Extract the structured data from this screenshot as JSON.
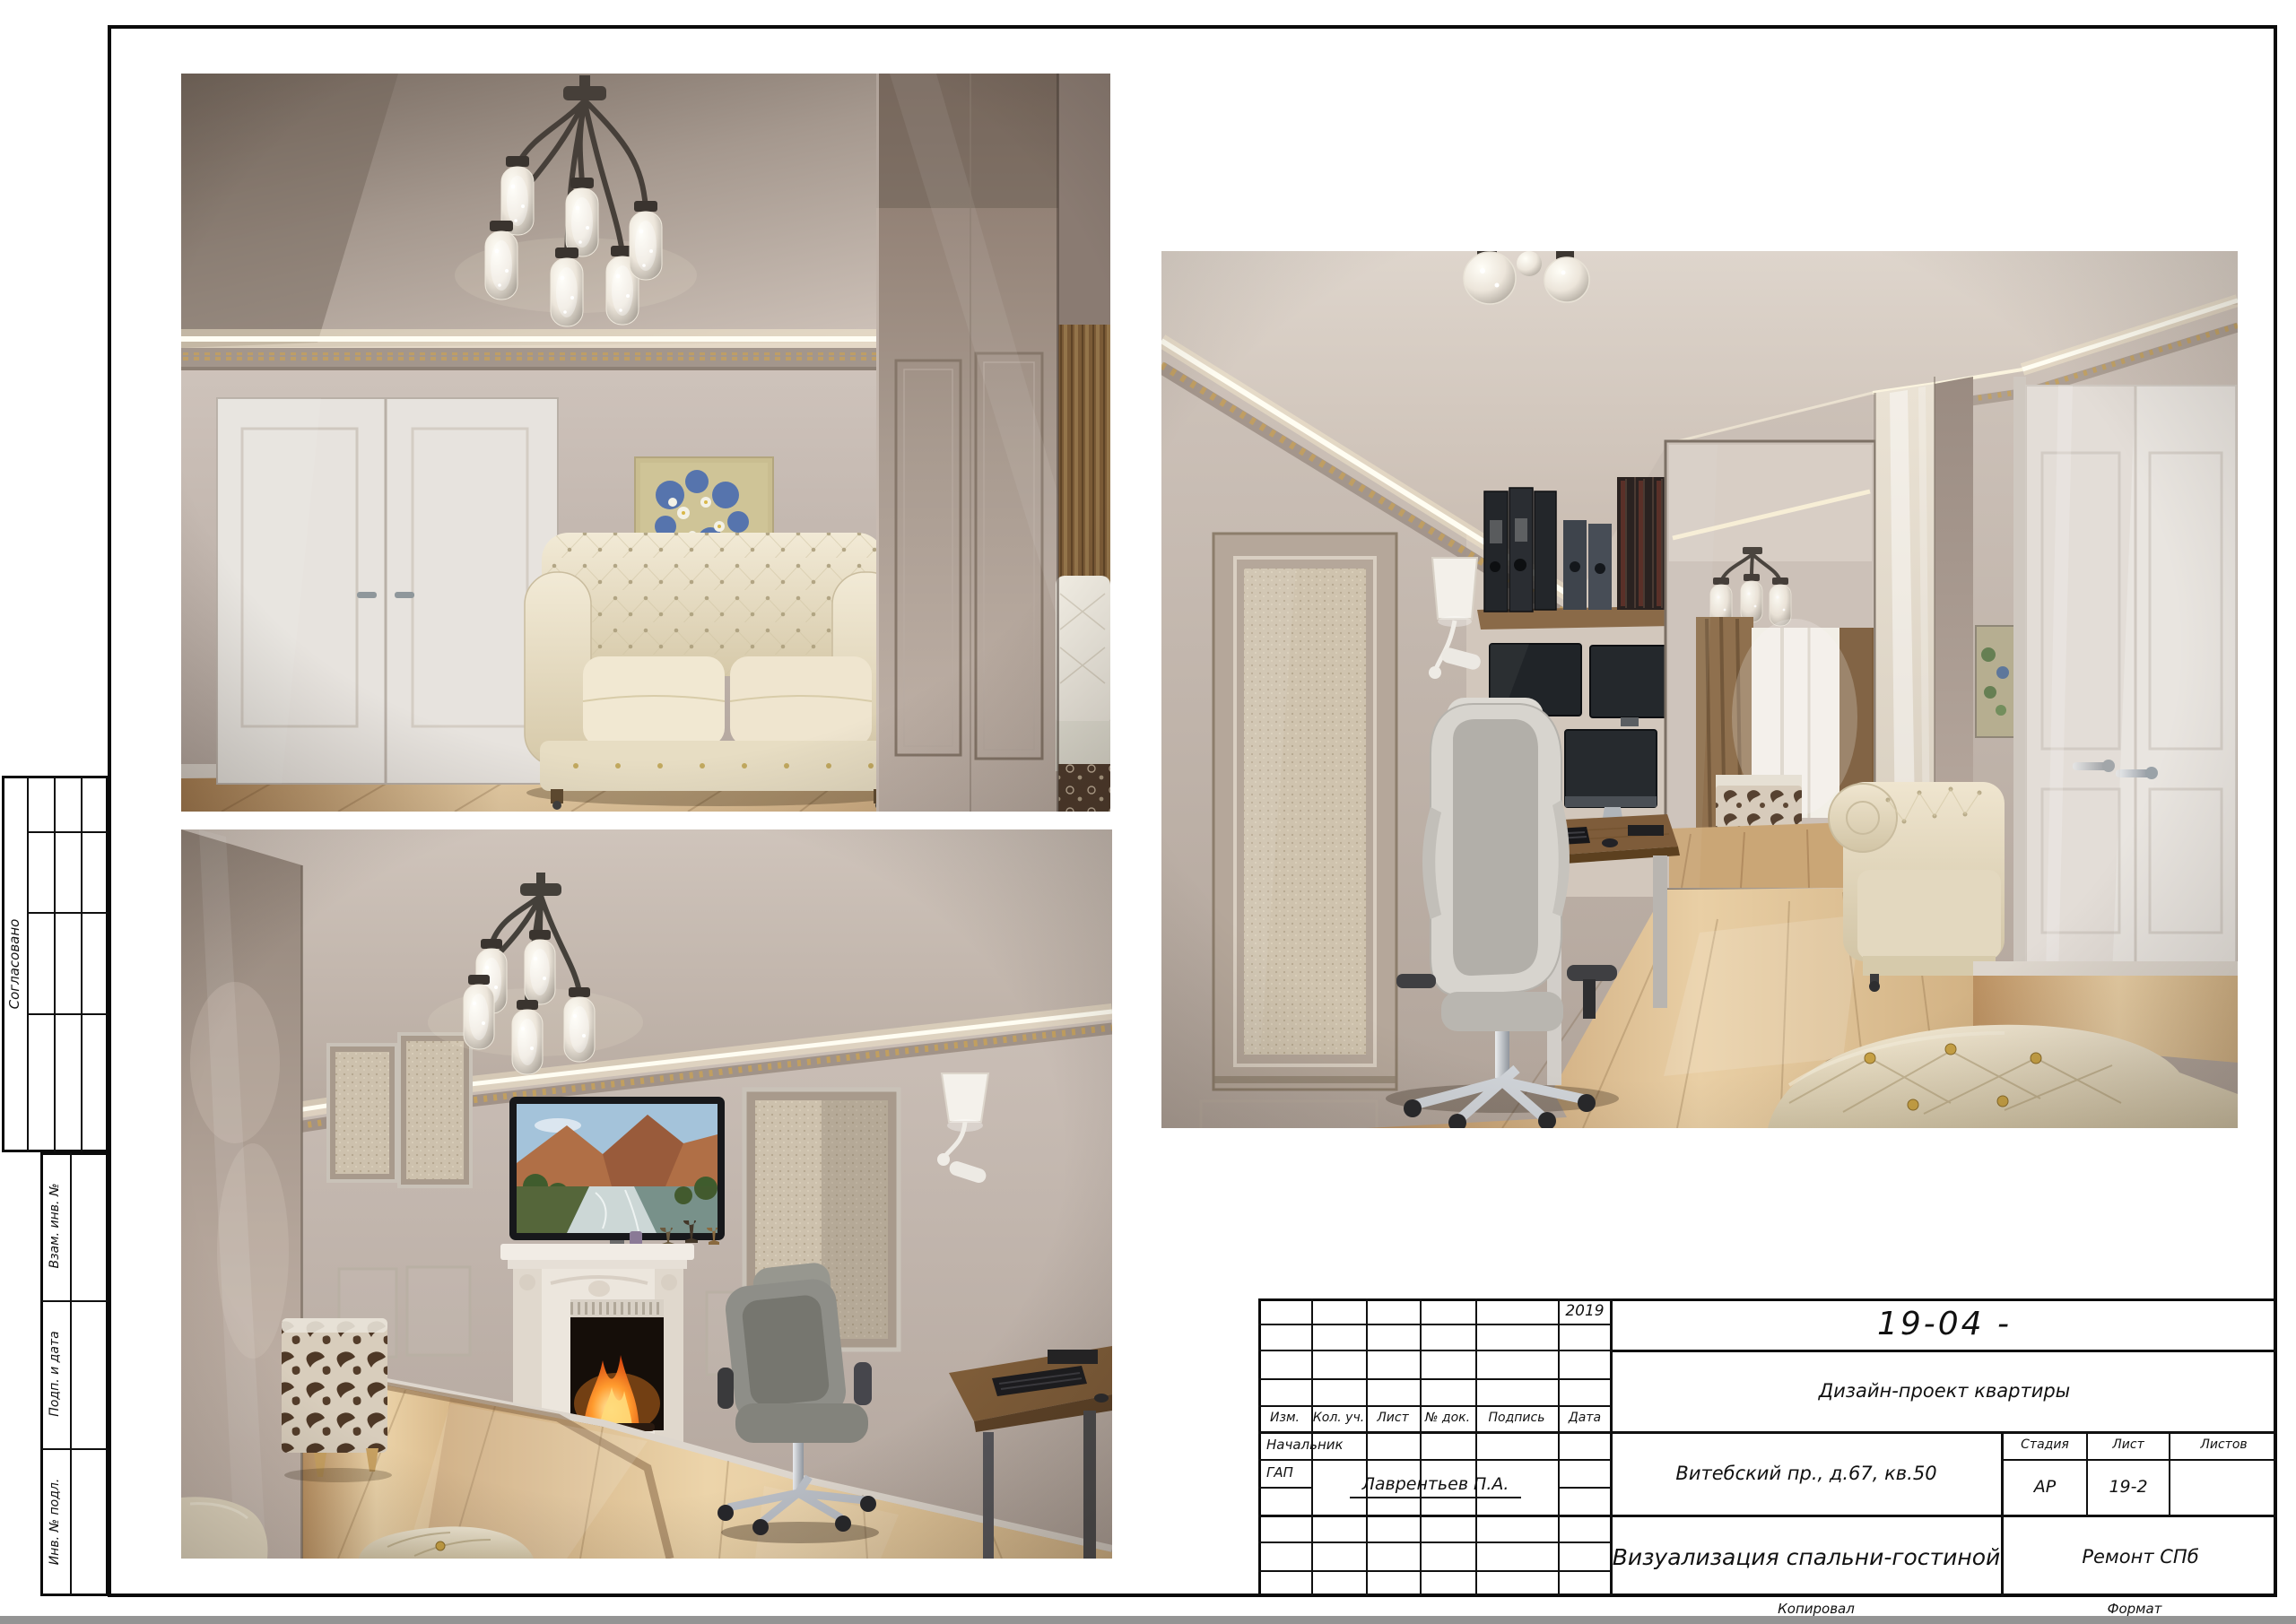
{
  "palette": {
    "paper": "#ffffff",
    "line": "#101010",
    "led_strip": "#fff8e0",
    "gold_molding": "#c7a159",
    "wall": "#c9bdb5",
    "ceiling": "#cfc3ba",
    "floor_light": "#e8cda2",
    "floor_dark": "#b48a5c",
    "sofa_cream": "#e9e0c8",
    "glossy_taupe": "#a4958b",
    "fire": "#ff7a1e",
    "screen_dark": "#23272b"
  },
  "title_block": {
    "code": "19-04  -",
    "year": "2019",
    "rev_headers": [
      "Изм.",
      "Кол. уч.",
      "Лист",
      "№ док.",
      "Подпись",
      "Дата"
    ],
    "project": "Дизайн-проект квартиры",
    "address": "Витебский пр., д.67, кв.50",
    "stage_label": "Стадия",
    "stage_value": "АР",
    "sheet_label": "Лист",
    "sheet_value": "19-2",
    "sheets_label": "Листов",
    "role_1": "Начальник",
    "role_2": "ГАП",
    "gap_name": "Лаврентьев П.А.",
    "drawing_title": "Визуализация спальни-гостиной",
    "company": "Ремонт СПб",
    "copied_label": "Копировал",
    "format_label": "Формат"
  },
  "side_stamp": {
    "agreed_label": "Согласовано",
    "vzam_label": "Взам. инв. №",
    "podp_label": "Подп. и дата",
    "inv_label": "Инв. № подл."
  }
}
